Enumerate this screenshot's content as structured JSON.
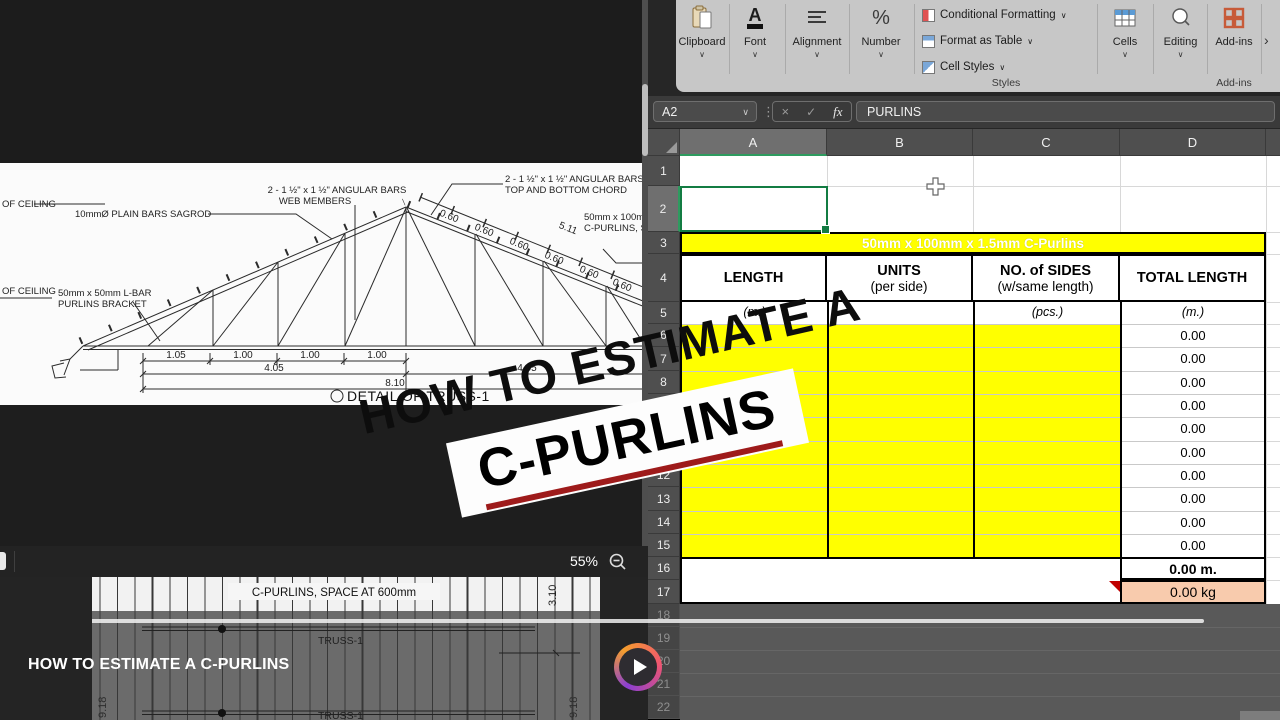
{
  "colors": {
    "banner_blue": "#2BA9E0",
    "banner_red": "#C00000",
    "cell_yellow": "#FFFF00",
    "cell_peach": "#F8CBAD",
    "excel_green": "#137C43"
  },
  "overlay": {
    "banner_line1": "HOW TO ESTIMATE A",
    "banner_line2": "C-PURLINS",
    "video_title": "HOW TO ESTIMATE A C-PURLINS"
  },
  "viewer": {
    "zoom_level": "55%",
    "truss": {
      "caption": "DETAIL OF  TRUSS-1",
      "label_ceiling": "OF CEILING",
      "label_sagrod": "10mmØ PLAIN BARS SAGROD",
      "label_web_1": "2 - 1 ½\" x 1 ½\" ANGULAR BARS",
      "label_web_2": "WEB MEMBERS",
      "label_chord_1": "2 - 1 ½\" x 1 ½\" ANGULAR BARS",
      "label_chord_2": "TOP AND BOTTOM CHORD",
      "label_purlins_1": "50mm x 100mm x 1",
      "label_purlins_2": "C-PURLINS, SPAC",
      "label_bracket_1": "50mm x 50mm L-BAR",
      "label_bracket_2": "PURLINS BRACKET",
      "dim_060": "0.60",
      "dim_511": "5.11",
      "dim_105": "1.05",
      "dim_100": "1.00",
      "dim_405": "4.05",
      "dim_810": "8.10"
    },
    "plan": {
      "label_spacing": "C-PURLINS, SPACE AT 600mm",
      "label_truss": "TRUSS-1",
      "dim_310": "3.10",
      "dim_918": "9.18"
    }
  },
  "excel": {
    "ribbon": {
      "groups": [
        "Clipboard",
        "Font",
        "Alignment",
        "Number"
      ],
      "styles_buttons": [
        "Conditional Formatting",
        "Format as Table",
        "Cell Styles"
      ],
      "styles_group_label": "Styles",
      "cells_label": "Cells",
      "editing_label": "Editing",
      "addins_label": "Add-ins",
      "addins_group_label": "Add-ins",
      "overflow_chevron": "›"
    },
    "formula_bar": {
      "name_box": "A2",
      "cancel": "×",
      "enter": "✓",
      "fx": "fx",
      "formula": "PURLINS"
    },
    "columns": [
      "A",
      "B",
      "C",
      "D"
    ],
    "row_numbers": [
      "1",
      "2",
      "3",
      "4",
      "5",
      "6",
      "7",
      "8",
      "9",
      "10",
      "11",
      "12",
      "13",
      "14",
      "15",
      "16",
      "17",
      "18",
      "19",
      "20",
      "21",
      "22"
    ],
    "table": {
      "title": "50mm x 100mm x 1.5mm C-Purlins",
      "headers": [
        {
          "line1": "LENGTH",
          "line2": ""
        },
        {
          "line1": "UNITS",
          "line2": "(per side)"
        },
        {
          "line1": "NO. of SIDES",
          "line2": "(w/same length)"
        },
        {
          "line1": "TOTAL LENGTH",
          "line2": ""
        }
      ],
      "subheaders": {
        "a": "(m.)",
        "c": "(pcs.)",
        "d": "(m.)"
      },
      "data_values": [
        "0.00",
        "0.00",
        "0.00",
        "0.00",
        "0.00",
        "0.00",
        "0.00",
        "0.00",
        "0.00",
        "0.00"
      ],
      "total_m": "0.00 m.",
      "total_kg": "0.00 kg"
    }
  }
}
